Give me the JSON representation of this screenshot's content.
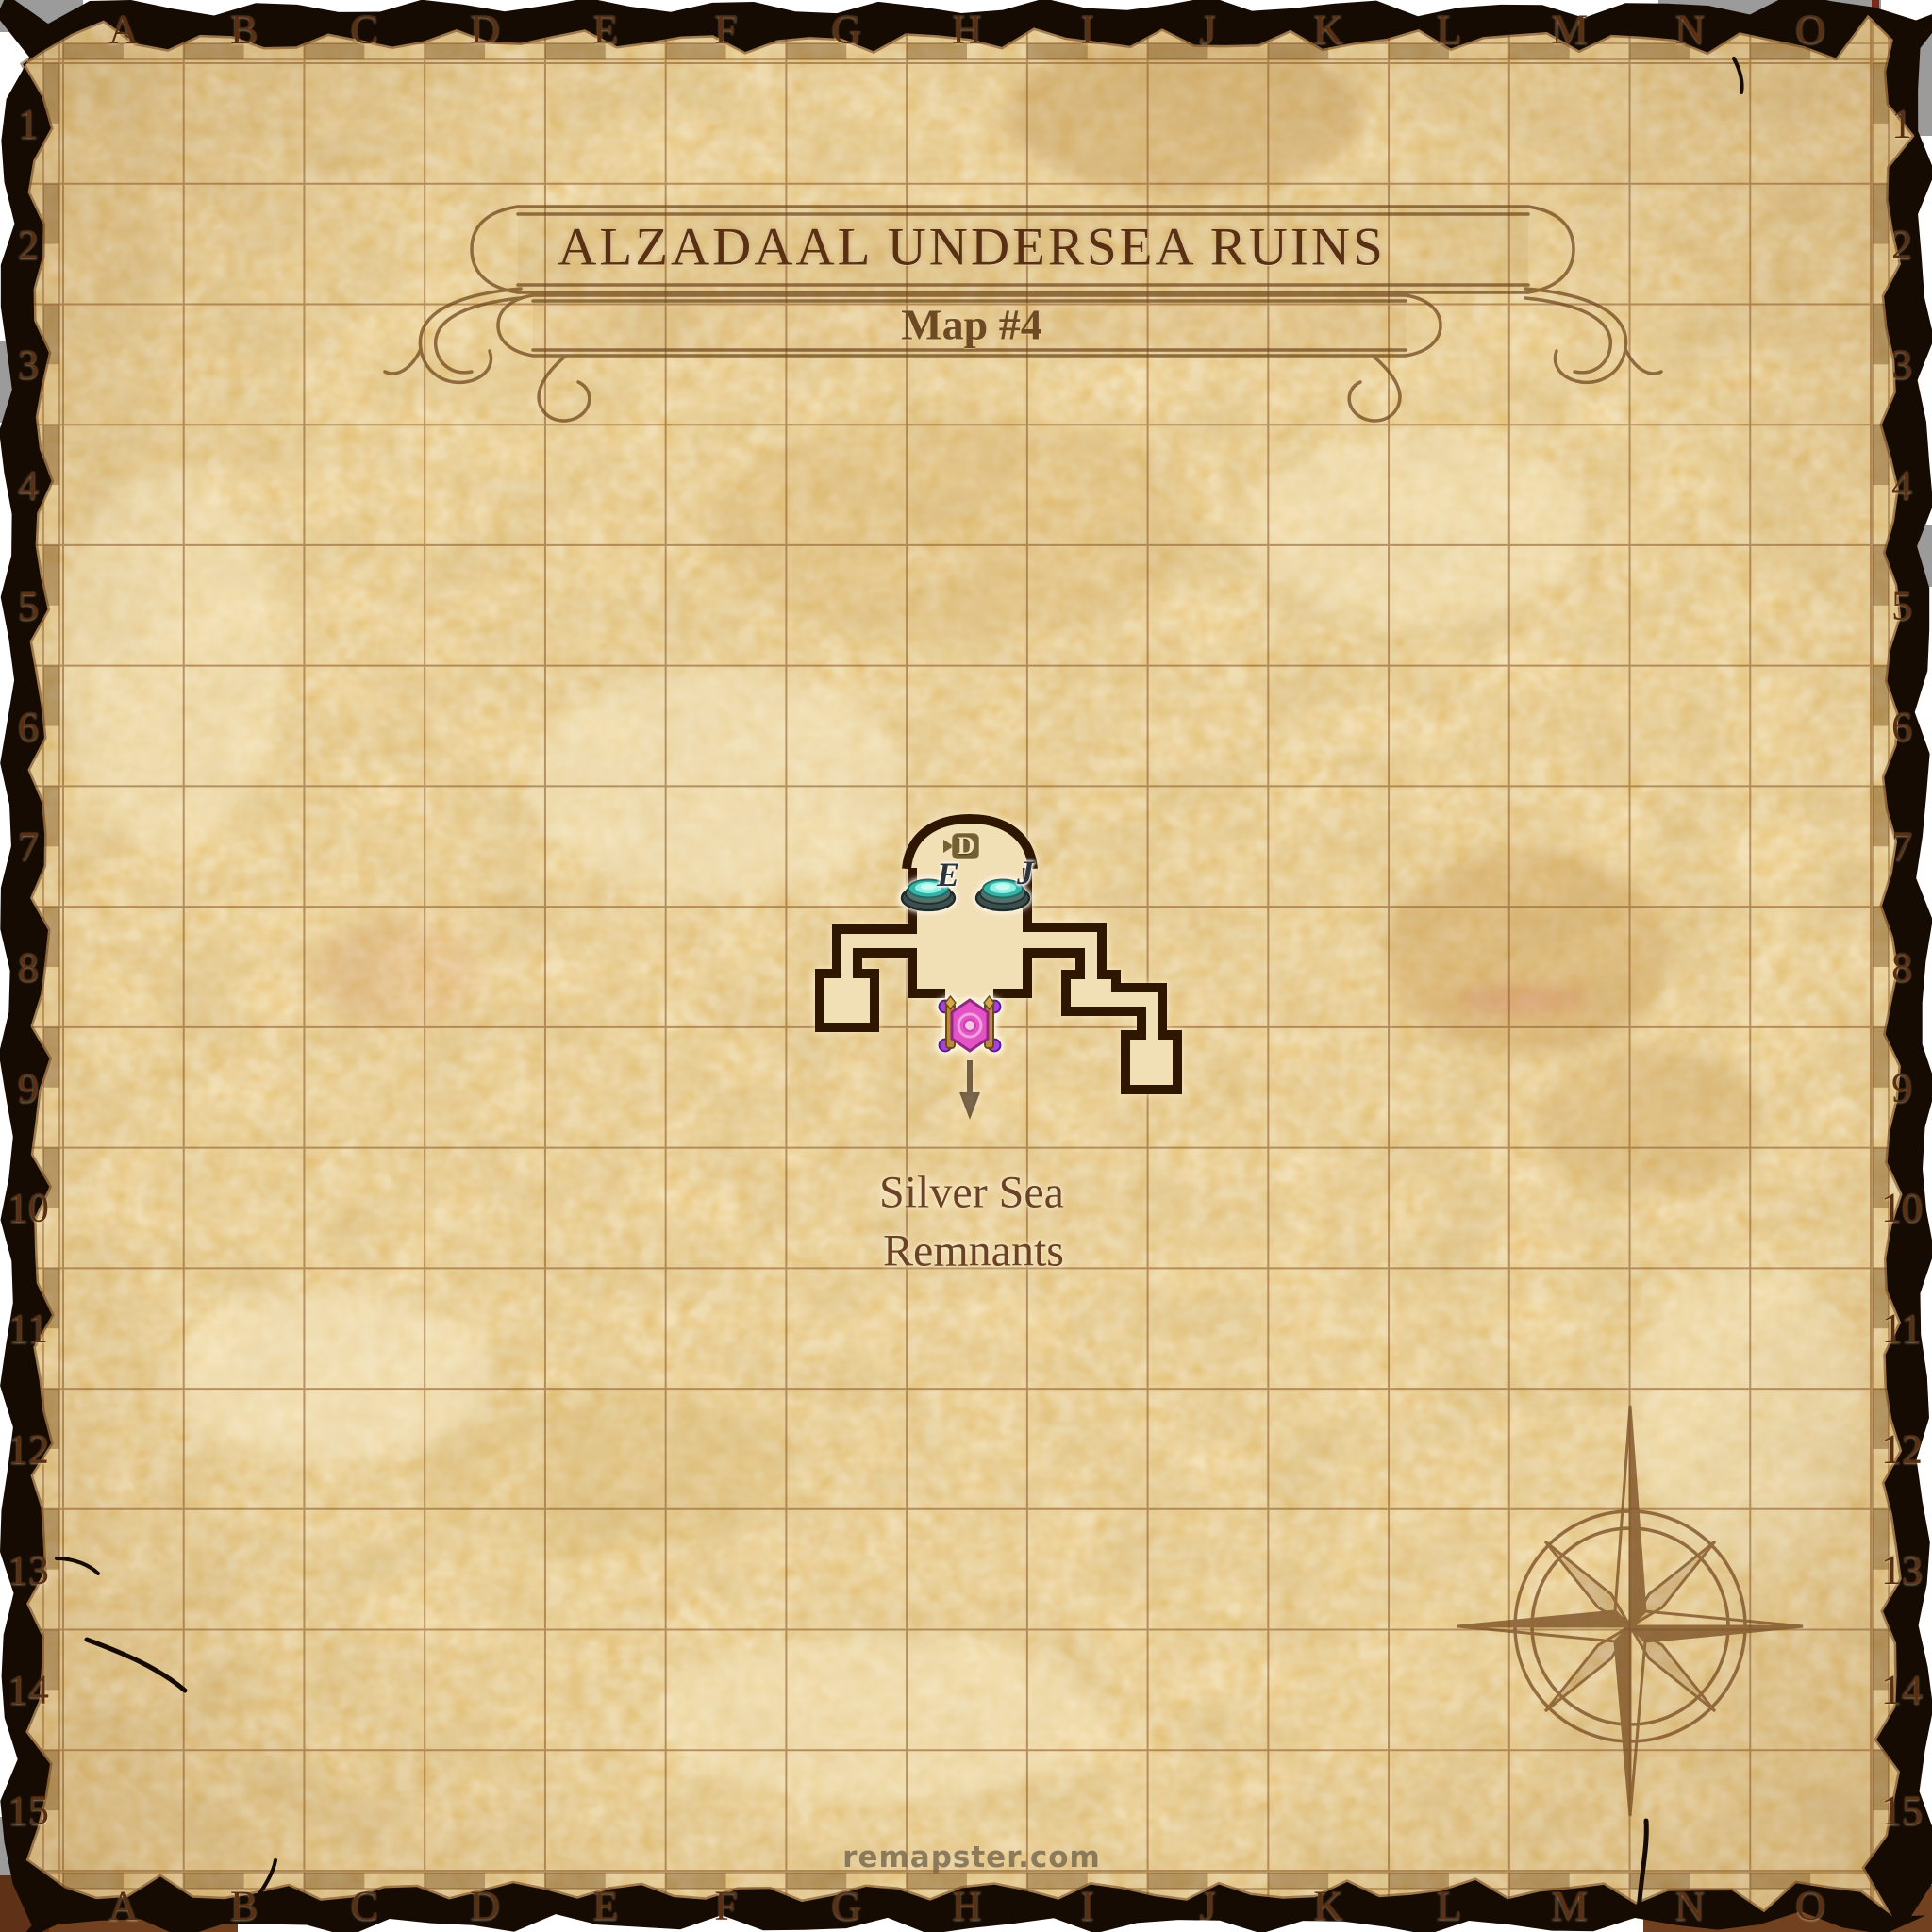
{
  "map": {
    "title": "ALZADAAL UNDERSEA RUINS",
    "map_number": "Map #4",
    "watermark": "remapster.com"
  },
  "grid": {
    "columns": [
      "A",
      "B",
      "C",
      "D",
      "E",
      "F",
      "G",
      "H",
      "I",
      "J",
      "K",
      "L",
      "M",
      "N",
      "O"
    ],
    "rows": [
      "1",
      "2",
      "3",
      "4",
      "5",
      "6",
      "7",
      "8",
      "9",
      "10",
      "11",
      "12",
      "13",
      "14",
      "15"
    ]
  },
  "labels": {
    "area_line1": "Silver Sea",
    "area_line2": "Remnants",
    "pad_e": "E",
    "pad_j": "J",
    "door": "D"
  },
  "colors": {
    "paper": "#e9c77f",
    "grid_line": "#8f5e2c",
    "ink": "#5a3014",
    "dungeon_wall": "#2f1505",
    "dungeon_floor": "#f1dfb6",
    "pad_glow": "#5ee8d8",
    "teleporter_pink": "#e352c6",
    "burnt_edge": "#150b03"
  }
}
